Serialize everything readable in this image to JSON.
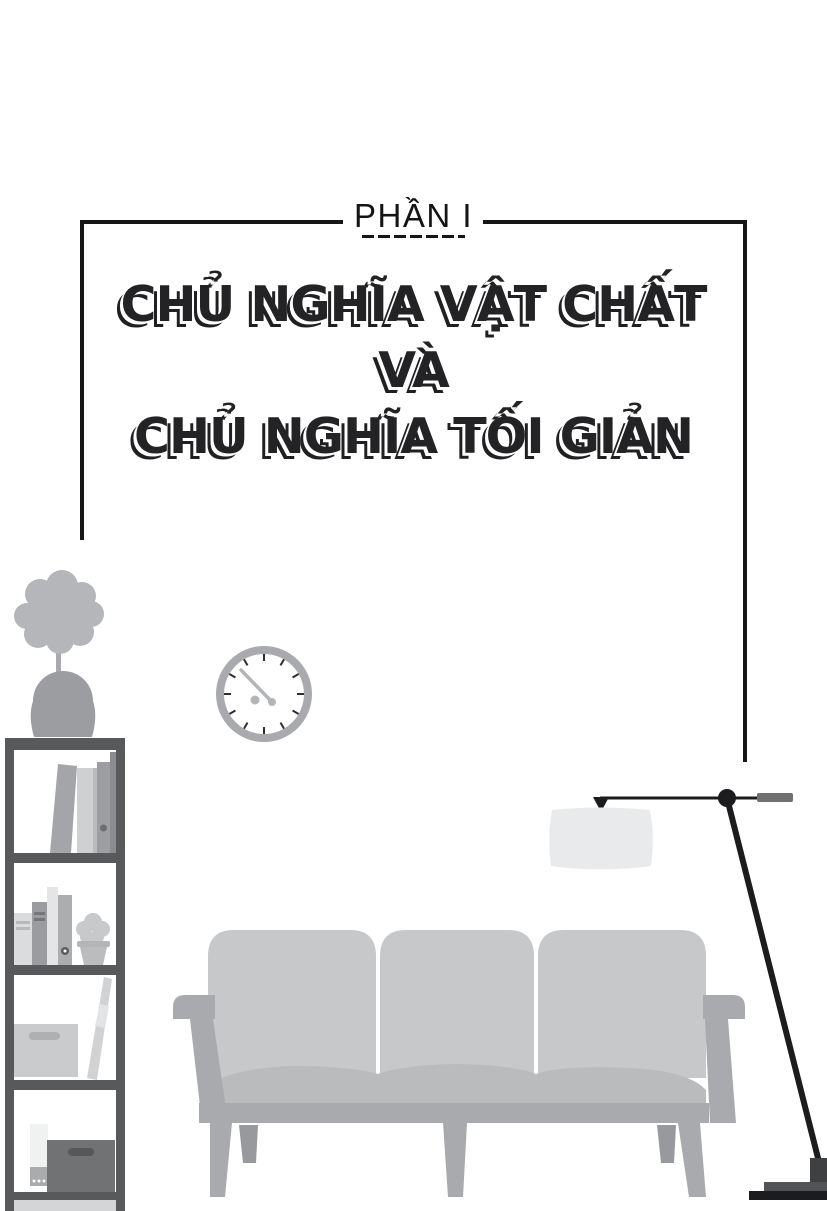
{
  "page": {
    "part_label": "PHẦN I",
    "title_lines": [
      "CHỦ NGHĨA VẬT CHẤT",
      "VÀ",
      "CHỦ NGHĨA TỐI GIẢN"
    ]
  },
  "illustration": {
    "scene": "minimalist living room",
    "elements": [
      "potted-plant",
      "bookshelf",
      "wall-clock",
      "sofa",
      "floor-lamp"
    ]
  },
  "palette": {
    "ink": "#1c1c1e",
    "illustration_light": "#c6c8ca",
    "illustration_mid": "#a8aaad",
    "illustration_dark": "#58595b",
    "lamp_shade": "#e9eaeb",
    "background": "#ffffff"
  }
}
